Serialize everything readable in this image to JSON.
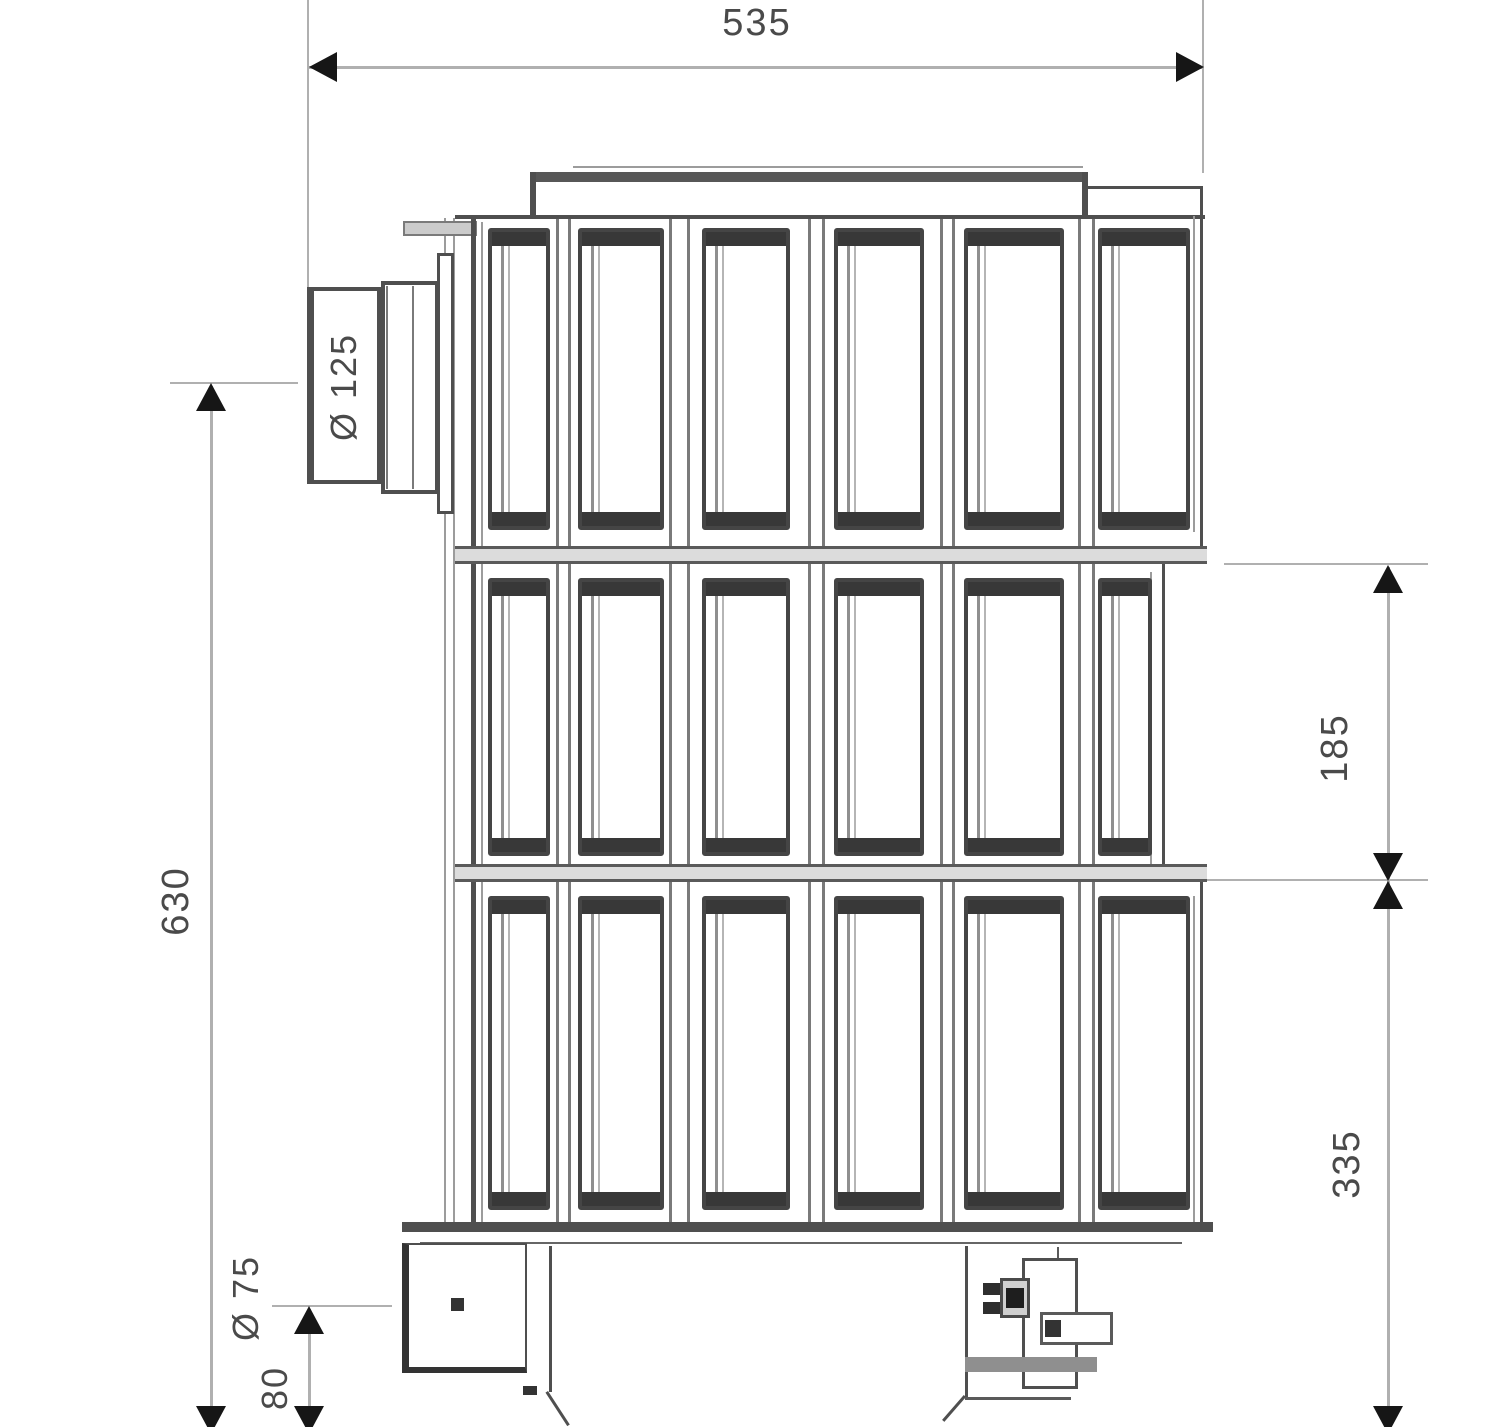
{
  "structure": {
    "grid_columns": 6,
    "grid_rows": 3
  },
  "dimensions": {
    "overall_width": "535",
    "overall_height": "630",
    "middle_section_height": "185",
    "lower_section_height": "335",
    "flue_outlet_diameter": "Ø 125",
    "drain_connection_diameter": "Ø 75",
    "drain_axis_height": "80"
  },
  "colors": {
    "background": "#ffffff",
    "line_dark": "#4f4f4f",
    "line_mid": "#7a7a7a",
    "line_light": "#9c9c9c",
    "dim_line": "#b0b0b0",
    "arrow": "#161616",
    "text": "#4a4a4a",
    "band_fill": "#dcdcdc",
    "cap_fill": "#383838",
    "panel_border": "#454545",
    "stripe": "#8f8f8f",
    "tab_fill": "#cbcbcb",
    "metal_fill": "#8f8f8f"
  }
}
